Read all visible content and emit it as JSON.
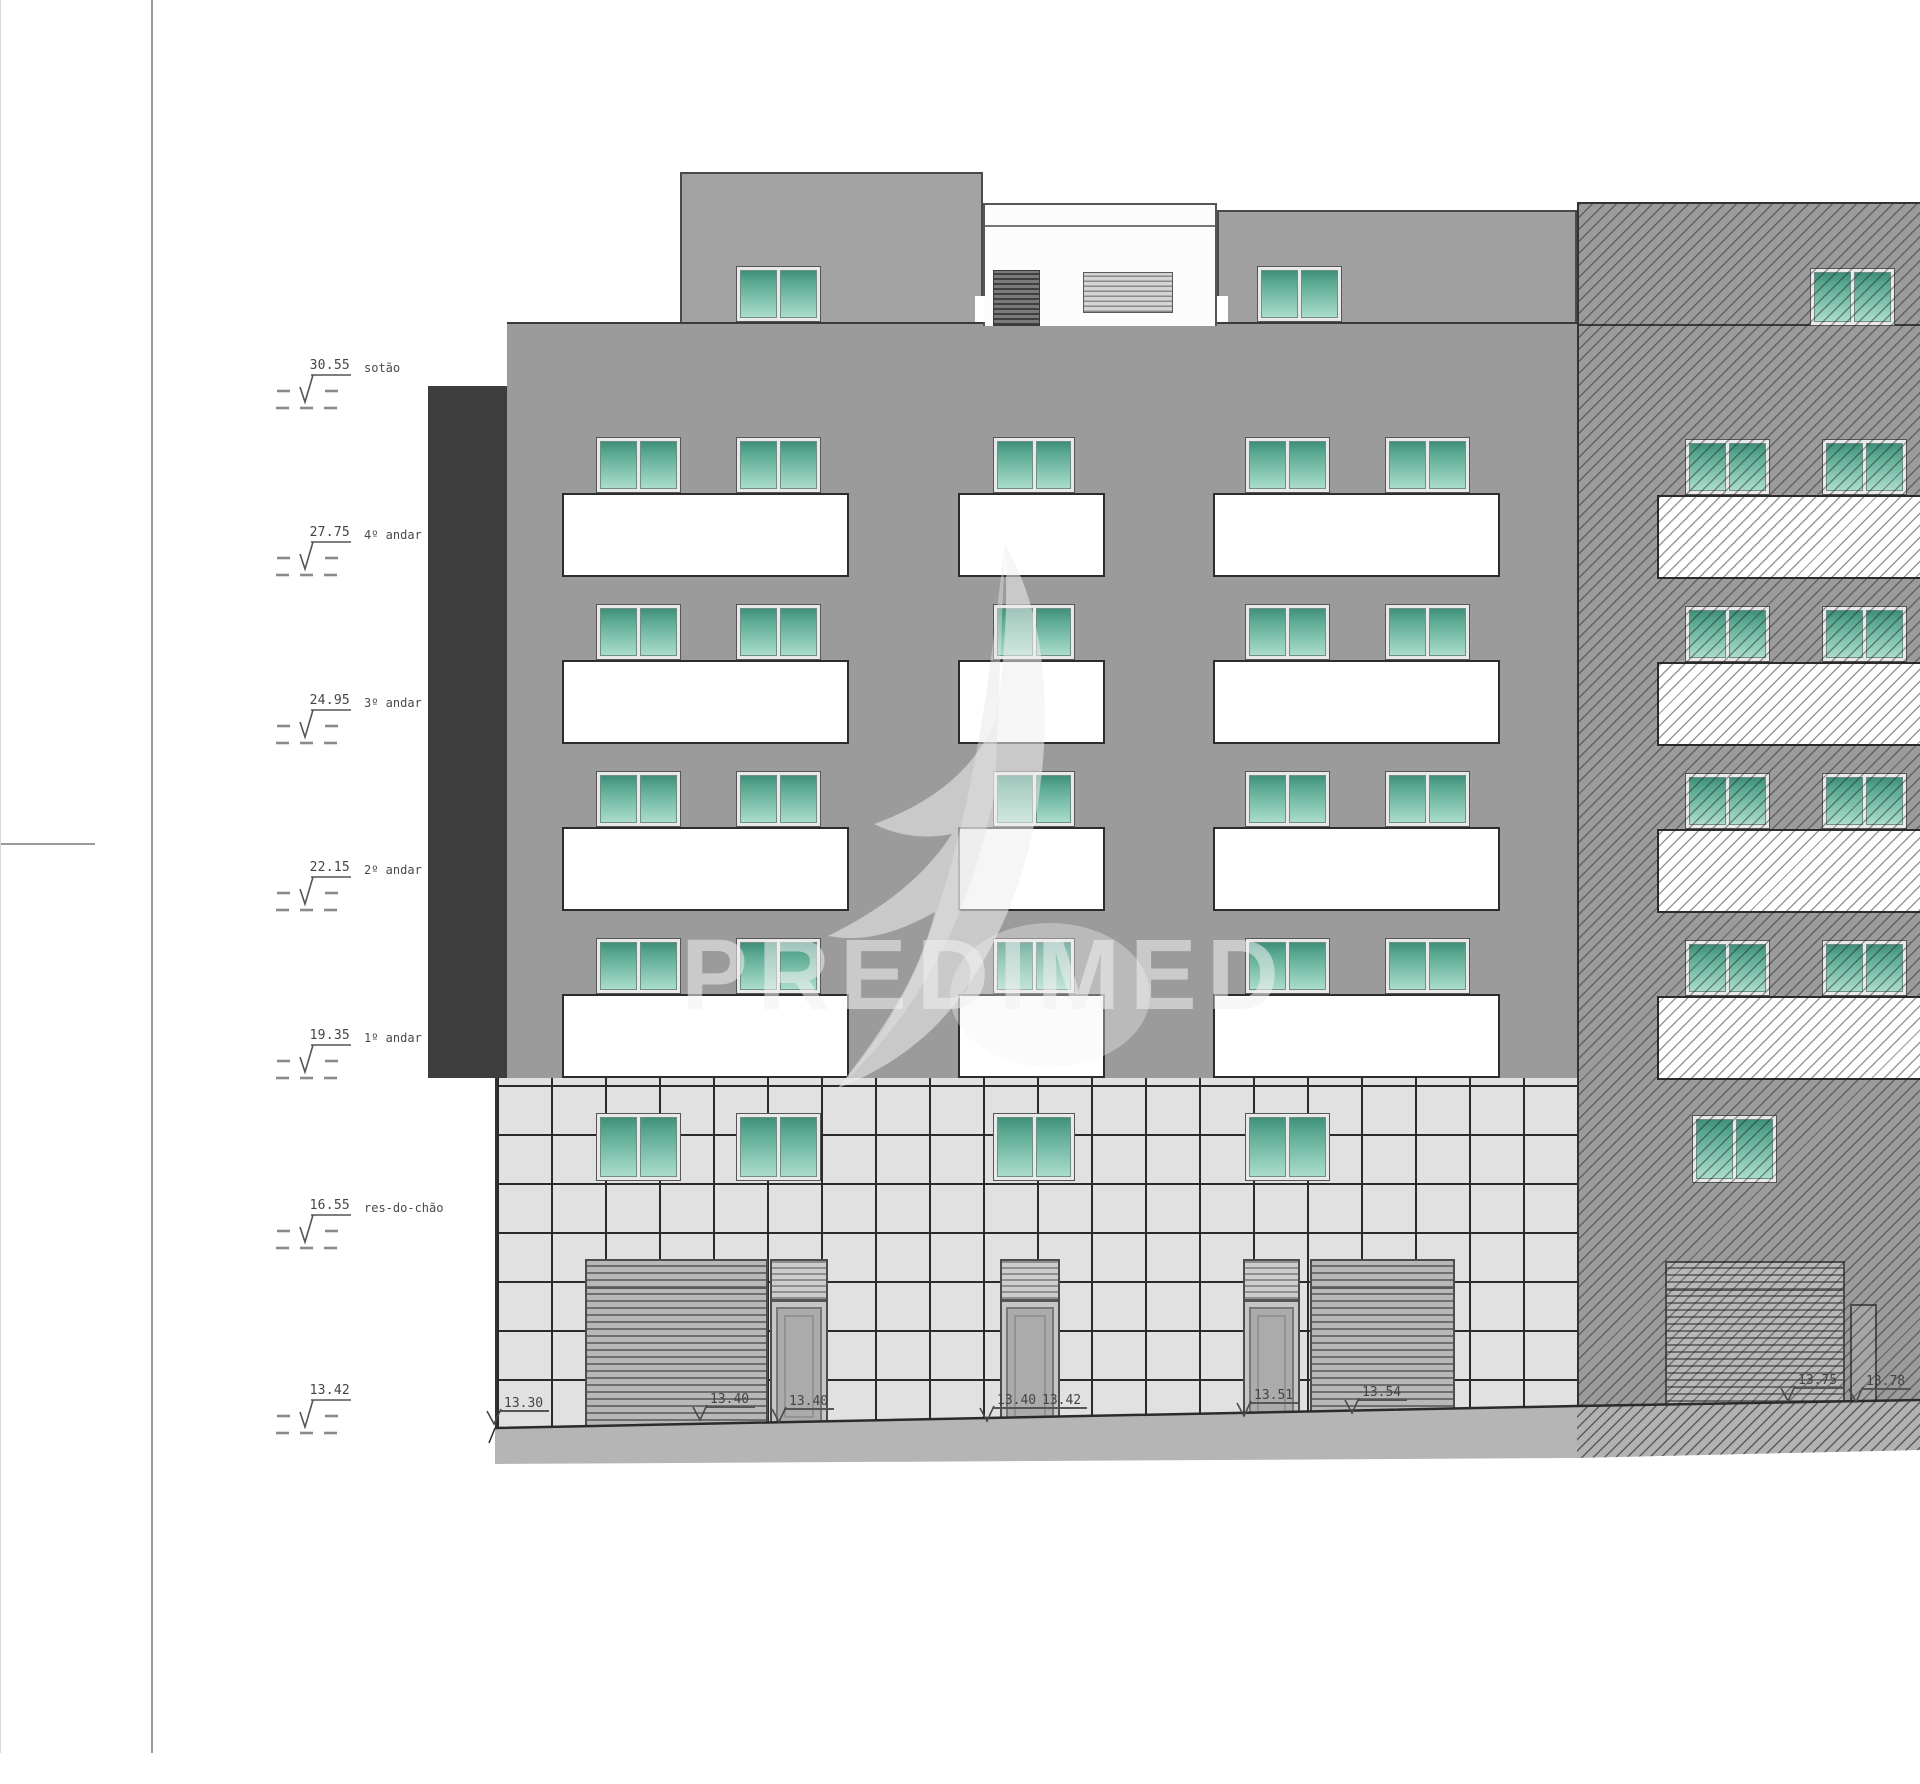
{
  "watermark": {
    "brand": "PREDIMED"
  },
  "elevation_markers": [
    {
      "value": "30.55",
      "label": "sotão"
    },
    {
      "value": "27.75",
      "label": "4º andar"
    },
    {
      "value": "24.95",
      "label": "3º andar"
    },
    {
      "value": "22.15",
      "label": "2º andar"
    },
    {
      "value": "19.35",
      "label": "1º andar"
    },
    {
      "value": "16.55",
      "label": "res-do-chão"
    },
    {
      "value": "13.42",
      "label": ""
    }
  ],
  "ground_level_marks": [
    {
      "value": "13.30"
    },
    {
      "value": "13.40"
    },
    {
      "value": "13.40"
    },
    {
      "value": "13.40"
    },
    {
      "value": "13.42"
    },
    {
      "value": "13.51"
    },
    {
      "value": "13.54"
    },
    {
      "value": "13.75"
    },
    {
      "value": "13.78"
    }
  ],
  "colors": {
    "facade_gray": "#9b9b9b",
    "penthouse_gray": "#a3a3a3",
    "dark_side_wall": "#3e3e3e",
    "window_green_top": "#3f8f7a",
    "window_green_bottom": "#abdccb",
    "balcony_white": "#ffffff",
    "tile_fill": "#e1e1e1",
    "ground_band": "#b5b5b5",
    "drawing_text": "#3c3c3c"
  }
}
